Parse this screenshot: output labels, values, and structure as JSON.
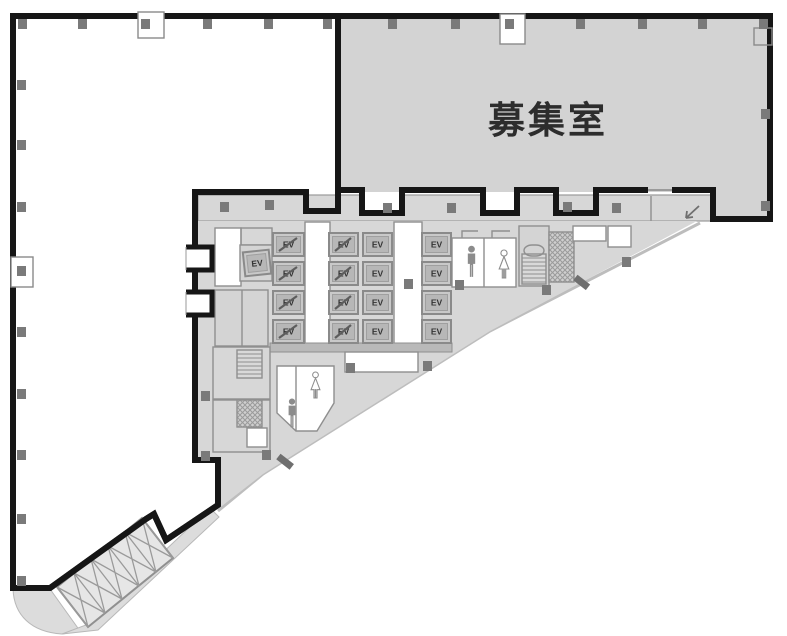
{
  "floor_plan": {
    "room_label": "募集室",
    "ev_label": "EV",
    "elevator_banks": [
      {
        "id": "bank-a",
        "cars": 4,
        "marked": true
      },
      {
        "id": "bank-b",
        "cars": 4,
        "marked": true
      },
      {
        "id": "bank-c",
        "cars": 4,
        "marked": false
      },
      {
        "id": "bank-d",
        "cars": 4,
        "marked": false
      },
      {
        "id": "bank-single",
        "cars": 1,
        "marked": false
      }
    ],
    "icons": {
      "man": "person-man-icon",
      "woman": "person-woman-icon",
      "stairs": "stair-hatch-icon",
      "shaft": "cross-hatch-shaft-icon",
      "escalator": "escalator-truss-icon",
      "entrance": "entrance-arrow-icon"
    },
    "colors": {
      "wall": "#161616",
      "leasable_fill": "#d3d3d3",
      "core_fill": "#d7d7d7",
      "thin_wall": "#8f8f8f",
      "column": "#7a7a7a",
      "slab_edge": "#bdbdbd"
    }
  }
}
